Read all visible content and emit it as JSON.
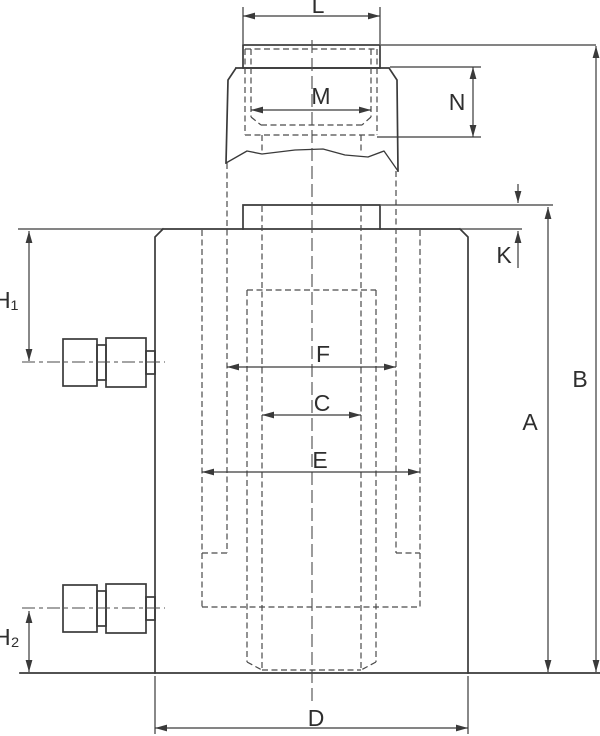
{
  "drawing": {
    "background": "#ffffff",
    "line_color": "#3a3a3a",
    "labels": {
      "L": "L",
      "M": "M",
      "N": "N",
      "K": "K",
      "H1": "H₁",
      "H2": "H₂",
      "A": "A",
      "B": "B",
      "C": "C",
      "D": "D",
      "E": "E",
      "F": "F"
    }
  }
}
